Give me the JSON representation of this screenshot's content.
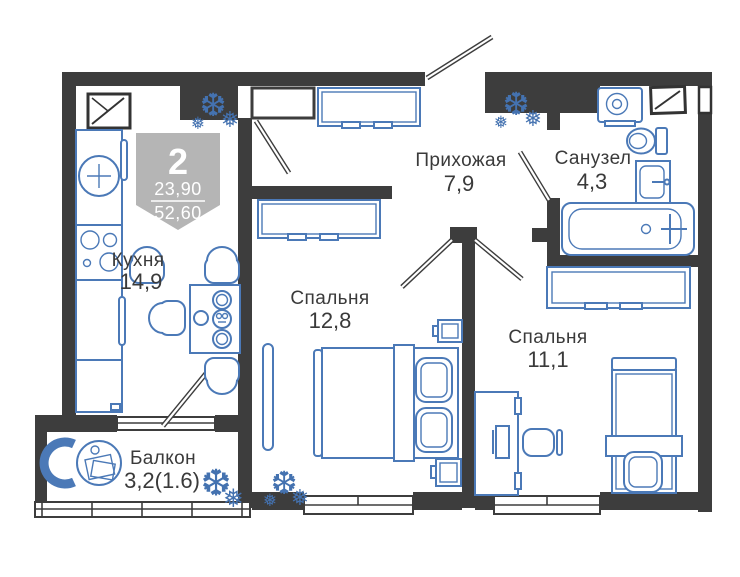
{
  "plan": {
    "badge": {
      "rooms_count": "2",
      "living_area": "23,90",
      "total_area": "52,60"
    },
    "rooms": [
      {
        "name": "Кухня",
        "area": "14,9"
      },
      {
        "name": "Прихожая",
        "area": "7,9"
      },
      {
        "name": "Санузел",
        "area": "4,3"
      },
      {
        "name": "Спальня",
        "area": "12,8"
      },
      {
        "name": "Спальня",
        "area": "11,1"
      },
      {
        "name": "Балкон",
        "area": "3,2(1.6)"
      }
    ],
    "colors": {
      "wall": "#3d3d3d",
      "furniture_outline": "#4b79b7",
      "label_text": "#3a3a3a",
      "badge_background": "#b5b5b5",
      "background": "#ffffff"
    }
  },
  "icons": {
    "plant": "❆",
    "plant_small": "❅"
  }
}
